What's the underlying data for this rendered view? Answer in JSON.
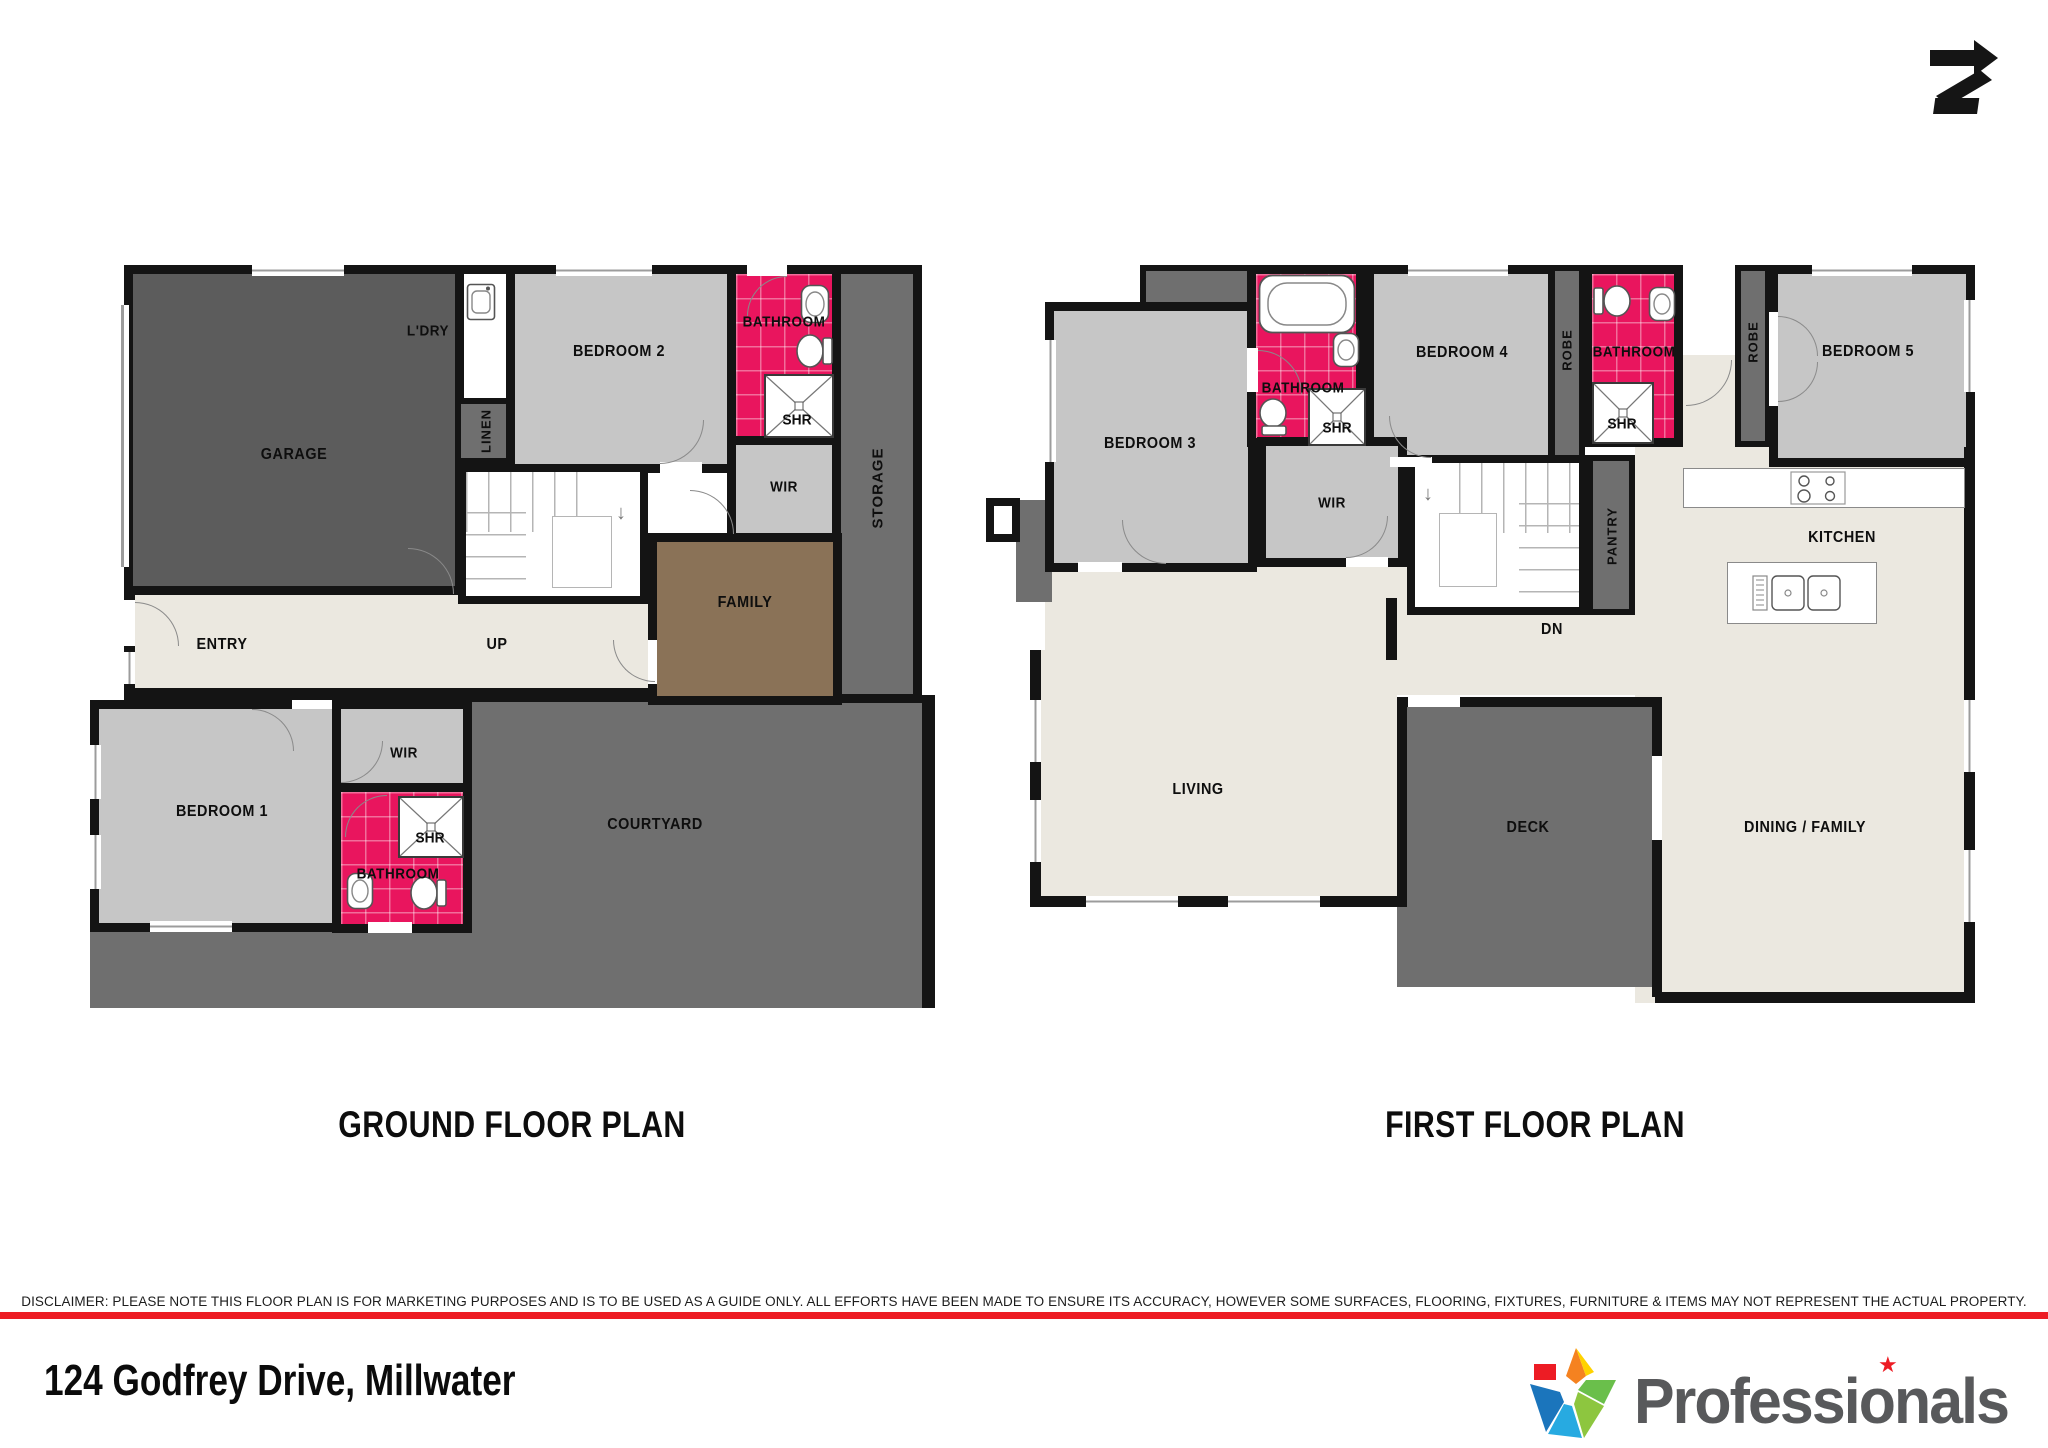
{
  "plans": [
    {
      "title": "GROUND FLOOR PLAN",
      "rooms": {
        "garage": "GARAGE",
        "ldry": "L'DRY",
        "linen": "LINEN",
        "bedroom2": "BEDROOM 2",
        "bathroom": "BATHROOM",
        "shr": "SHR",
        "wir": "WIR",
        "storage": "STORAGE",
        "up": "UP",
        "family": "FAMILY",
        "entry": "ENTRY",
        "bedroom1": "BEDROOM 1",
        "wir2": "WIR",
        "shr2": "SHR",
        "bathroom2": "BATHROOM",
        "courtyard": "COURTYARD"
      }
    },
    {
      "title": "FIRST FLOOR PLAN",
      "rooms": {
        "bedroom3": "BEDROOM 3",
        "bathroom1": "BATHROOM",
        "shr1": "SHR",
        "bedroom4": "BEDROOM 4",
        "robe1": "ROBE",
        "bathroom2": "BATHROOM",
        "shr2": "SHR",
        "robe2": "ROBE",
        "bedroom5": "BEDROOM 5",
        "wir": "WIR",
        "pantry": "PANTRY",
        "dn": "DN",
        "kitchen": "KITCHEN",
        "living": "LIVING",
        "deck": "DECK",
        "dining": "DINING / FAMILY"
      }
    }
  ],
  "footer": {
    "disclaimer": "DISCLAIMER: PLEASE NOTE THIS FLOOR PLAN IS FOR MARKETING PURPOSES AND IS TO BE USED AS A GUIDE ONLY. ALL EFFORTS HAVE BEEN MADE TO ENSURE ITS ACCURACY, HOWEVER SOME SURFACES, FLOORING, FIXTURES, FURNITURE & ITEMS MAY NOT REPRESENT THE ACTUAL PROPERTY.",
    "address": "124 Godfrey Drive, Millwater",
    "brand": "Professionals"
  },
  "colors": {
    "accent_red": "#ed1c24",
    "bathroom_pink": "#e9155e",
    "brand_gray": "#58595b"
  }
}
